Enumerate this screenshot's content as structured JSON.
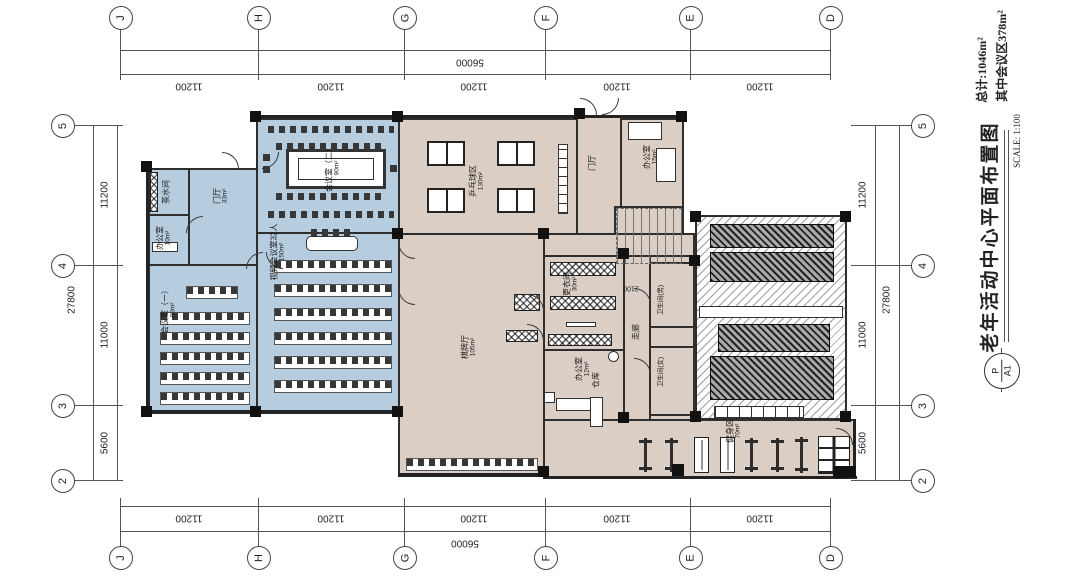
{
  "sheet": {
    "title": "老年活动中心平面布置图",
    "scale_label": "SCALE: 1:100",
    "total_area": "总计:1046m²",
    "meeting_area": "其中会议区378m²",
    "stamp_top": "P",
    "stamp_bottom": "A1"
  },
  "grid": {
    "cols": [
      "J",
      "H",
      "G",
      "F",
      "E",
      "D"
    ],
    "rows": [
      "5",
      "4",
      "3",
      "2"
    ],
    "col_span_dims": [
      "11200",
      "11200",
      "11200",
      "11200",
      "11200"
    ],
    "col_total_dim": "56000",
    "row_span_dims": [
      "11200",
      "11000",
      "5600"
    ],
    "row_total_dim": "27800",
    "corridor_dim": "2100"
  },
  "rooms": {
    "tea_room": {
      "name": "茶水间",
      "area": ""
    },
    "office_10": {
      "name": "办公室",
      "area": "10m²"
    },
    "foyer_left": {
      "name": "门厅",
      "area": "33m²"
    },
    "meeting_2": {
      "name": "会议室（二）",
      "area": "90m²"
    },
    "video_conference": {
      "name": "视频会议室32人",
      "area": "150m²"
    },
    "meeting_1": {
      "name": "会议室（一）",
      "area": "80m²"
    },
    "table_tennis": {
      "name": "乒乓球区",
      "area": "130m²"
    },
    "foyer_right": {
      "name": "门厅",
      "area": ""
    },
    "office_15": {
      "name": "办公室",
      "area": "15m²"
    },
    "chess_hall": {
      "name": "棋牌厅",
      "area": "105m²"
    },
    "locker_room": {
      "name": "更衣间",
      "area": "30m²"
    },
    "office_12": {
      "name": "办公室",
      "area": "12m²"
    },
    "storage": {
      "name": "仓库",
      "area": ""
    },
    "corridor": {
      "name": "走廊",
      "area": ""
    },
    "toilet_male": {
      "name": "卫生间(男)",
      "area": ""
    },
    "toilet_female": {
      "name": "卫生间(女)",
      "area": ""
    },
    "fitness": {
      "name": "健身区",
      "area": "70m²"
    }
  },
  "colors": {
    "meeting_zone_fill": "#b6cddf",
    "activity_zone_fill": "#dbcfc5",
    "wall": "#2e2e2e"
  }
}
